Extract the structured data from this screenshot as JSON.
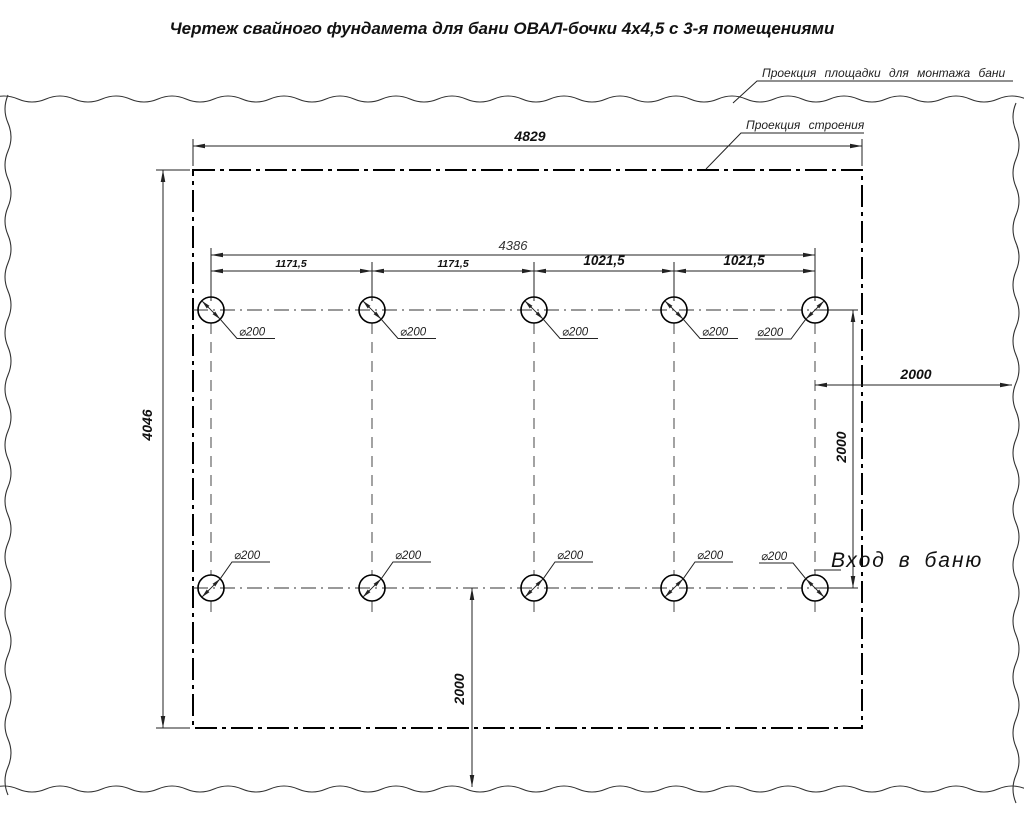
{
  "title": "Чертеж свайного фундамета для бани ОВАЛ-бочки 4х4,5 с 3-я помещениями",
  "callouts": {
    "site": "Проекция площадки для монтажа бани",
    "building": "Проекция строения",
    "entrance": "Вход в баню"
  },
  "piles": {
    "diameter_label": "⌀200"
  },
  "dimensions": {
    "building_width": "4829",
    "building_height": "4046",
    "pile_span": "4386",
    "spacing_1": "1171,5",
    "spacing_2": "1171,5",
    "spacing_3": "1021,5",
    "spacing_4": "1021,5",
    "entrance_offset": "2000",
    "row_spacing": "2000",
    "bottom_offset": "2000"
  }
}
